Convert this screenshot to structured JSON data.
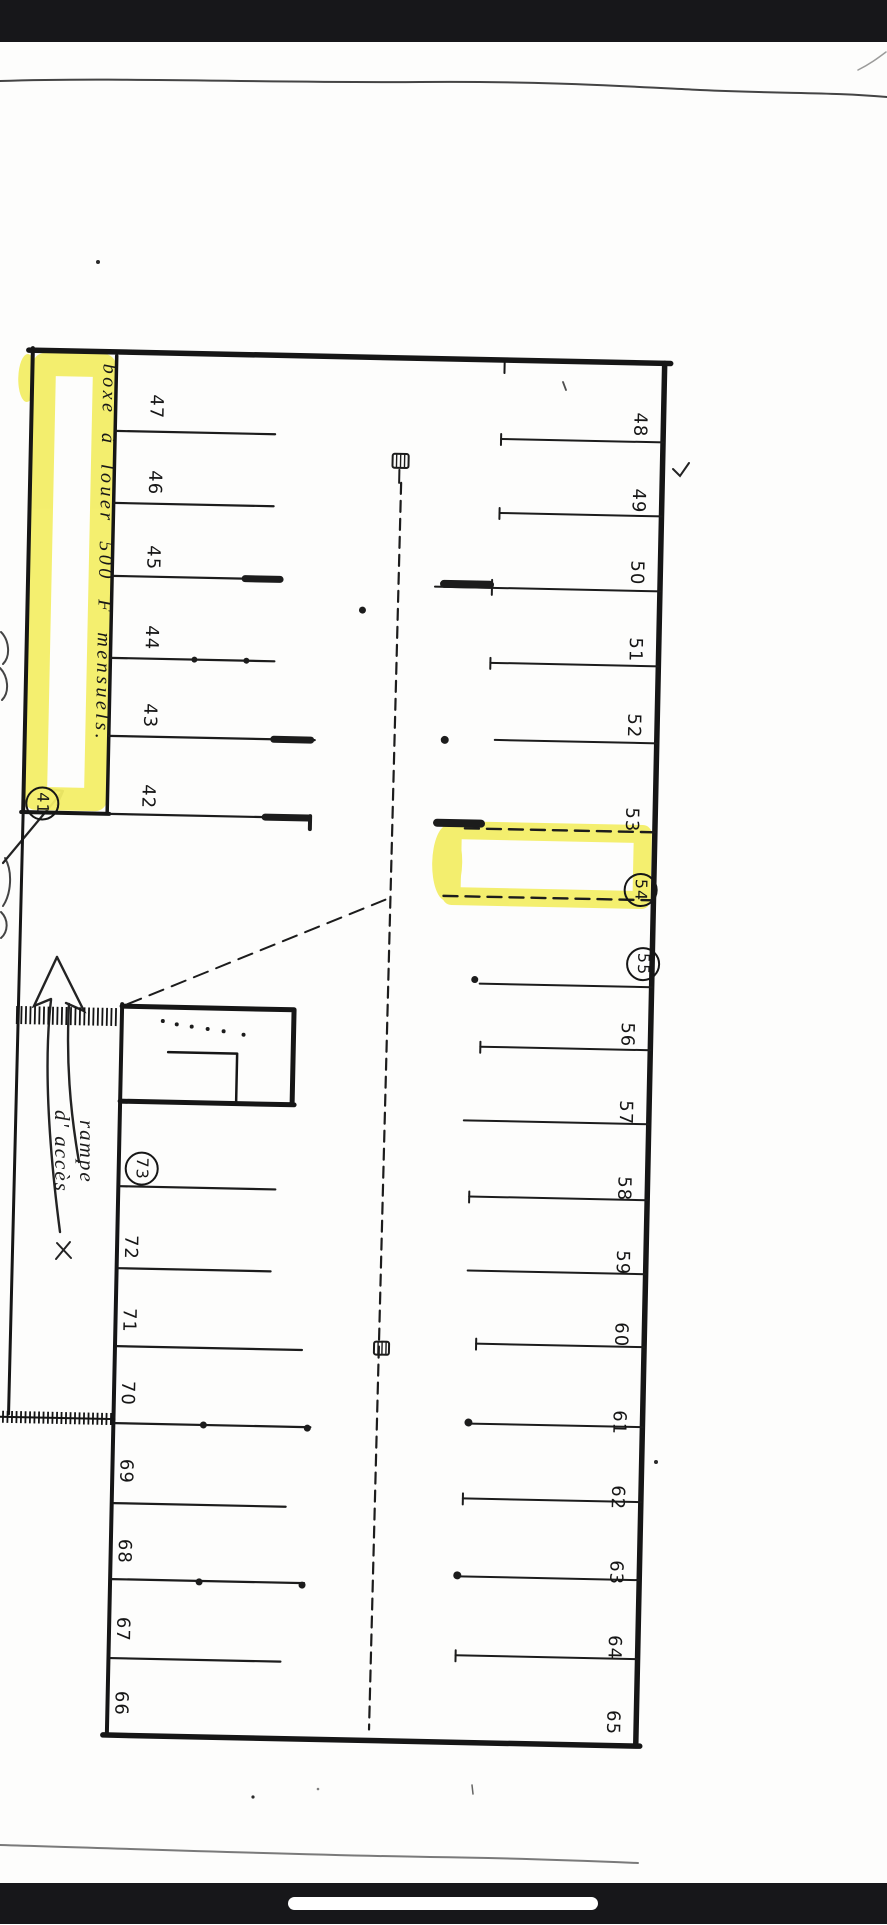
{
  "plan": {
    "ink_color": "#1b1b1b",
    "highlight_color": "#f3ee67",
    "notes": {
      "box_note": "boxe à louer 500 F mensuels.",
      "ramp_note_line1": "rampe",
      "ramp_note_line2": "d' accès"
    },
    "spaces": {
      "box": "41",
      "upper_left": [
        "47",
        "46",
        "45",
        "44",
        "43",
        "42"
      ],
      "right": [
        "48",
        "49",
        "50",
        "51",
        "52",
        "53",
        "54",
        "55",
        "56",
        "57",
        "58",
        "59",
        "60",
        "61",
        "62",
        "63",
        "64",
        "65"
      ],
      "lower_left": [
        "73",
        "72",
        "71",
        "70",
        "69",
        "68",
        "67",
        "66"
      ],
      "circled": [
        "41",
        "54",
        "55",
        "73"
      ],
      "highlighted": [
        "41",
        "54"
      ]
    }
  }
}
